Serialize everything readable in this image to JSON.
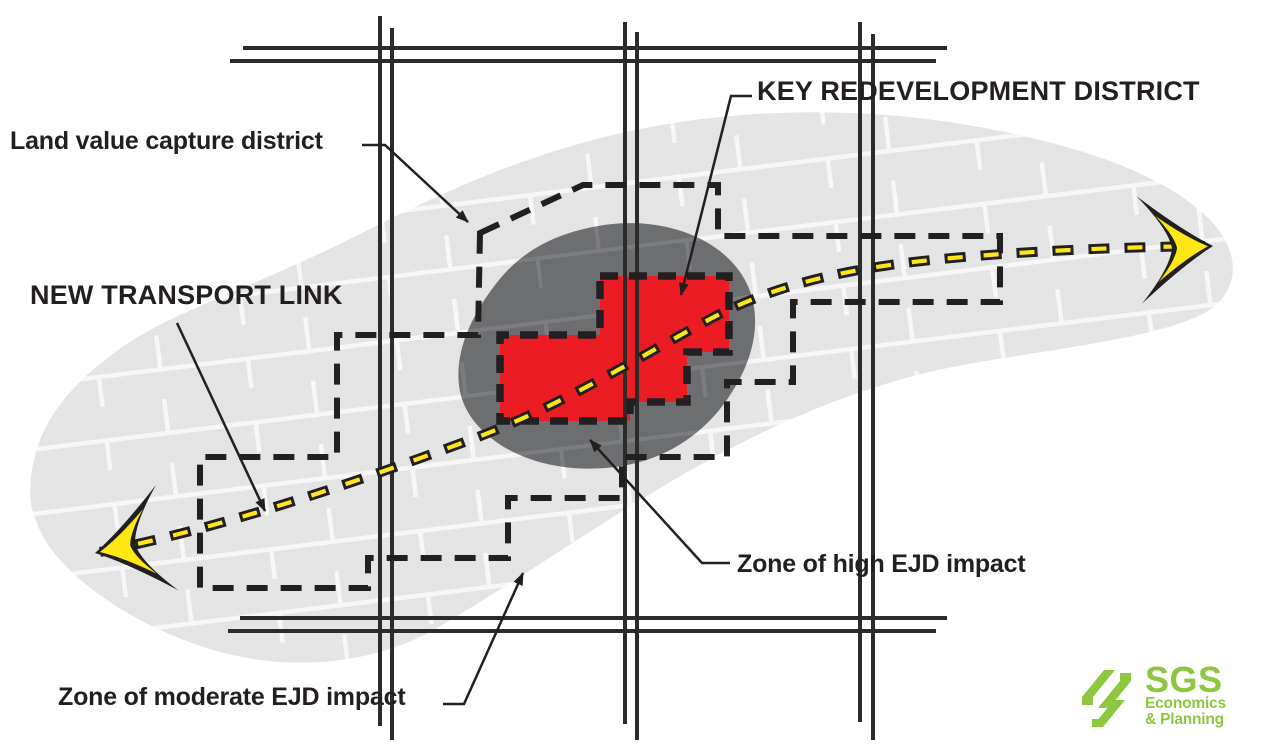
{
  "labels": {
    "land_value_capture": "Land value capture district",
    "new_transport_link": "NEW TRANSPORT LINK",
    "key_redevelopment_district": "KEY REDEVELOPMENT DISTRICT",
    "zone_high_impact": "Zone of high EJD impact",
    "zone_moderate_impact": "Zone of moderate EJD impact"
  },
  "logo": {
    "acronym": "SGS",
    "line1": "Economics",
    "line2": "& Planning"
  },
  "colors": {
    "red_district": "#ec1c24",
    "dark_gray_zone": "#6d6e70",
    "light_gray_zone": "#e4e4e5",
    "block_street_light": "#f7f7f8",
    "block_street_dark": "#7c7d80",
    "yellow_line": "#ffe715",
    "line_black": "#231f20",
    "street_gray": "#2d2a2b",
    "logo_green": "#8dc63f"
  }
}
